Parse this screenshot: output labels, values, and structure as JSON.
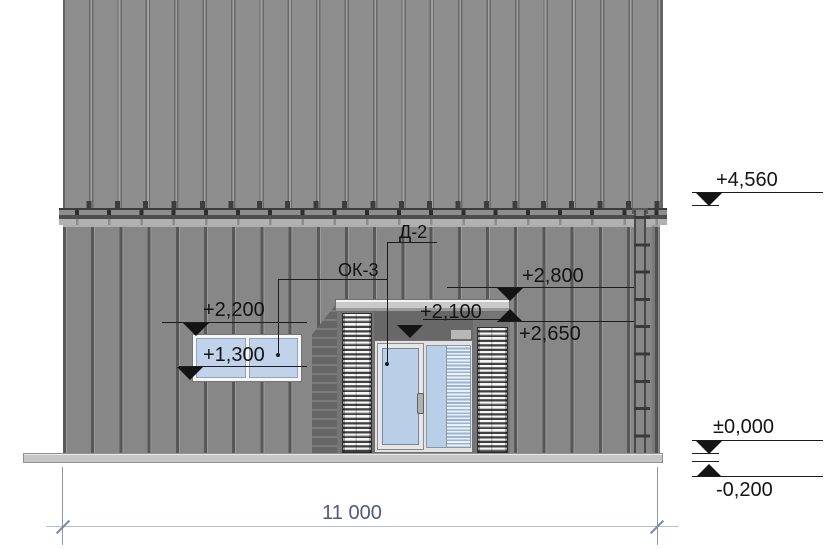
{
  "tags": {
    "door": "Д-2",
    "window": "ОК-3"
  },
  "elevations": {
    "eave": "+4,560",
    "canopy_top": "+2,800",
    "canopy_underside": "+2,650",
    "window_head": "+2,200",
    "door_head": "+2,100",
    "window_sill": "+1,300",
    "floor_level": "±0,000",
    "ground_level": "-0,200"
  },
  "dimensions": {
    "overall_width": "11 000"
  },
  "colors": {
    "roof": "#8e8e8e",
    "wall": "#878787",
    "plinth": "#c6c6c6",
    "glass": "#c0d3ea",
    "canopy": "#c9c9c9",
    "annotation": "#1a1a1a",
    "dimension_text": "#4d5b80",
    "dimension_line": "#b4becf"
  }
}
